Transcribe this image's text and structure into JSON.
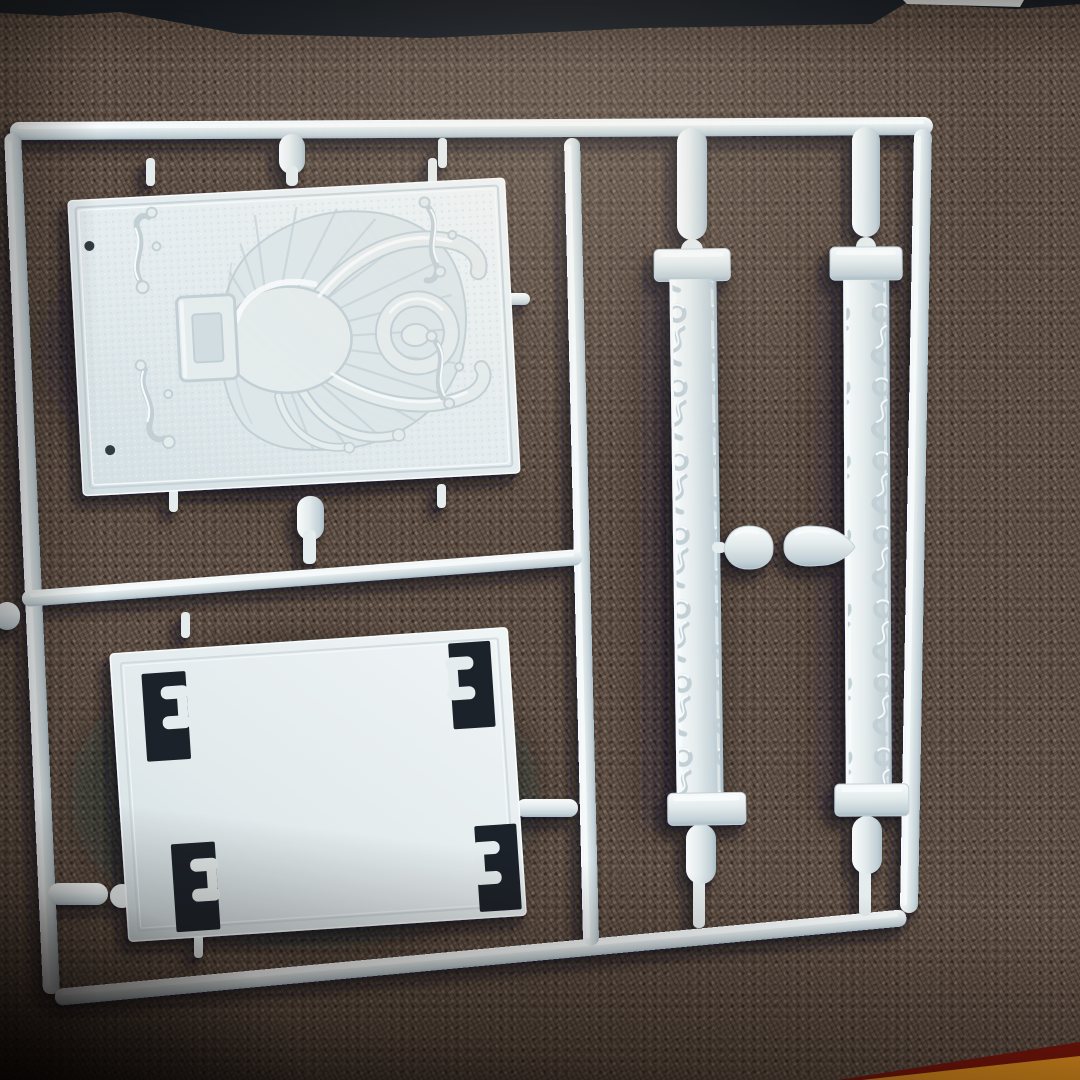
{
  "scene": {
    "type": "photograph",
    "subject": "Unassembled light-grey plastic model-kit runner (sprue) lying on brown woven fabric",
    "sprue": {
      "frame_rails": [
        "top-rail",
        "left-rail",
        "right-rail",
        "bottom-rail",
        "center-divider-rail",
        "middle-cross-rail"
      ],
      "parts": [
        {
          "name": "emblem-plaque",
          "detail": "box-lid plaque with embossed horned-creature relief over a radiating shell, belt buckle, scroll ornaments in each corner, two pin holes"
        },
        {
          "name": "blank-panel",
          "detail": "flat rectangular panel with four stepped corner cutouts"
        },
        {
          "name": "ornate-strip-left",
          "detail": "vertical trim strip with scroll-and-ring embossing and end caps"
        },
        {
          "name": "ornate-strip-right",
          "detail": "vertical trim strip with scroll-and-ring embossing and end caps"
        },
        {
          "name": "capsule-part-small",
          "detail": "small rounded capsule part on the centre tie"
        },
        {
          "name": "capsule-part-large",
          "detail": "bullet-shaped capsule part on the centre tie"
        }
      ]
    },
    "surroundings": {
      "surface": "brown tweed fabric with visible diagonal weave",
      "top_edge": "dark navy box edge with a small white sliver",
      "bottom_right": "orange box-lid edge with dark red trim"
    }
  },
  "colors": {
    "plastic-base": "#e5eced",
    "plastic-light": "#f8fbfc",
    "plastic-shade": "#c2d0d6",
    "plastic-deep": "#a8bbc4",
    "plastic-field": "#dde7ea",
    "panel-hole": "#1b222c",
    "fabric-base": "#5d4e44",
    "fabric-dark": "#241b15",
    "band-navy": "#151c24",
    "sliver-white": "#e9eceb",
    "accent-orange": "#f0991f",
    "accent-red": "#7e150b"
  }
}
